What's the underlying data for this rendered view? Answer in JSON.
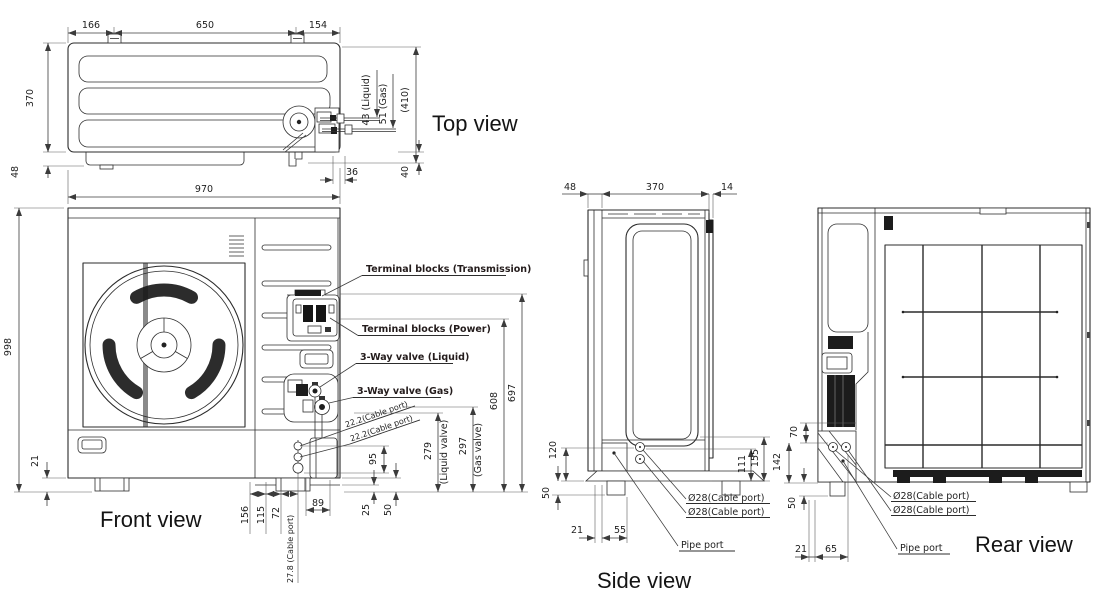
{
  "views": {
    "top": {
      "title": "Top view",
      "dims": {
        "mountLeft": "166",
        "mountMid": "650",
        "mountRight": "154",
        "depth": "370",
        "rear": "48",
        "liquid": "43 (Liquid)",
        "gas": "51 (Gas)",
        "overall": "(410)",
        "pipe36": "36",
        "pipe40": "40"
      }
    },
    "front": {
      "title": "Front view",
      "dims": {
        "width": "970",
        "height": "998",
        "base": "21",
        "ports": "95",
        "p156": "156",
        "p115": "115",
        "p72": "72",
        "p89": "89",
        "p25": "25",
        "p50": "50",
        "liquidH": "279",
        "liquidNote": "(Liquid valve)",
        "gasH": "297",
        "gasNote": "(Gas valve)",
        "powerH": "608",
        "transH": "697"
      },
      "labels": {
        "trans": "Terminal blocks (Transmission)",
        "power": "Terminal blocks (Power)",
        "valveLiquid": "3-Way valve (Liquid)",
        "valveGas": "3-Way valve (Gas)",
        "cable22a": "22.2(Cable port)",
        "cable22b": "22.2(Cable port)",
        "cable278": "27.8 (Cable port)"
      }
    },
    "side": {
      "title": "Side view",
      "dims": {
        "front": "48",
        "depth": "370",
        "rear": "14",
        "pipeH": "120",
        "foot": "50",
        "b21": "21",
        "b55": "55",
        "p111": "111",
        "p155": "155"
      },
      "labels": {
        "cable1": "Ø28(Cable port)",
        "cable2": "Ø28(Cable port)",
        "pipe": "Pipe port"
      }
    },
    "rear": {
      "title": "Rear view",
      "dims": {
        "v70": "70",
        "v142": "142",
        "v50": "50",
        "b21": "21",
        "b65": "65"
      },
      "labels": {
        "cable1": "Ø28(Cable port)",
        "cable2": "Ø28(Cable port)",
        "pipe": "Pipe port"
      }
    }
  }
}
